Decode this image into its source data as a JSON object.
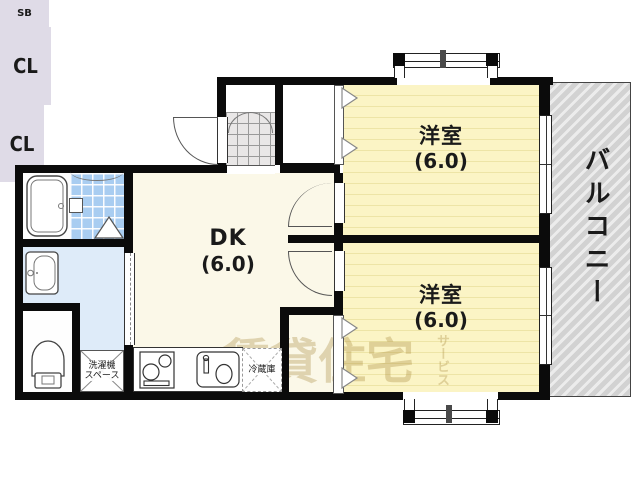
{
  "rooms": {
    "western1": {
      "label": "洋室",
      "size": "(6.0)"
    },
    "western2": {
      "label": "洋室",
      "size": "(6.0)"
    },
    "dk": {
      "label": "DK",
      "size": "(6.0)"
    }
  },
  "storage": {
    "closet1": "CL",
    "closet2": "CL",
    "shoebox": "SB"
  },
  "balcony": {
    "label": "バルコニー"
  },
  "kitchen": {
    "refrigerator": "冷蔵庫",
    "washer_line1": "洗濯機",
    "washer_line2": "スペース"
  },
  "watermark": {
    "main": "賃貸住宅",
    "sub": "サービス"
  },
  "colors": {
    "wall": "#0B0B0B",
    "tatami_room": "#FBF4C5",
    "tatami_stripe": "#EDE4A6",
    "dk": "#FBF8E8",
    "closet": "#DFDBE7",
    "bath_tile": "#A9CDF1",
    "washroom": "#DEEBF9",
    "balcony": "#D9D9D9"
  }
}
